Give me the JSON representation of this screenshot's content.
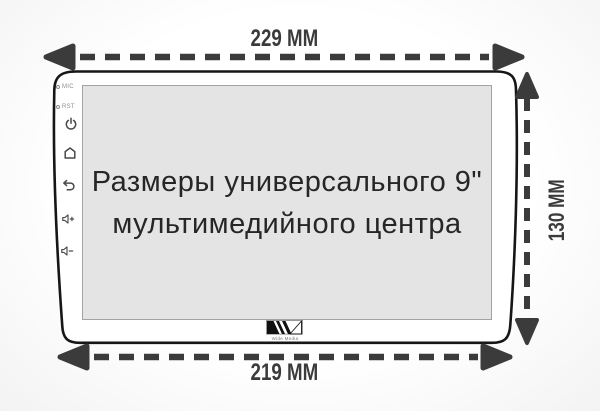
{
  "diagram_title": "Universal 9-inch multimedia head unit dimensions",
  "dimensions": {
    "top_width": "229 MM",
    "bottom_width": "219 MM",
    "side_height": "130 MM"
  },
  "screen": {
    "caption_line1": "Размеры универсального 9\"",
    "caption_line2": "мультимедийного центра"
  },
  "side_panel": {
    "mic_label": "MIC",
    "rst_label": "RST",
    "icons": [
      "power-icon",
      "home-icon",
      "back-icon",
      "volume-up-icon",
      "volume-down-icon"
    ]
  },
  "logo": {
    "text": "Wide Media"
  },
  "colors": {
    "arrow": "#3b3b3b",
    "body_outline": "#161616",
    "screen_fill": "#e4e4e4",
    "screen_border": "#a3a3a3",
    "icon": "#4a4a4a",
    "muted_label": "#8d8d8d",
    "caption_text": "#262626"
  }
}
